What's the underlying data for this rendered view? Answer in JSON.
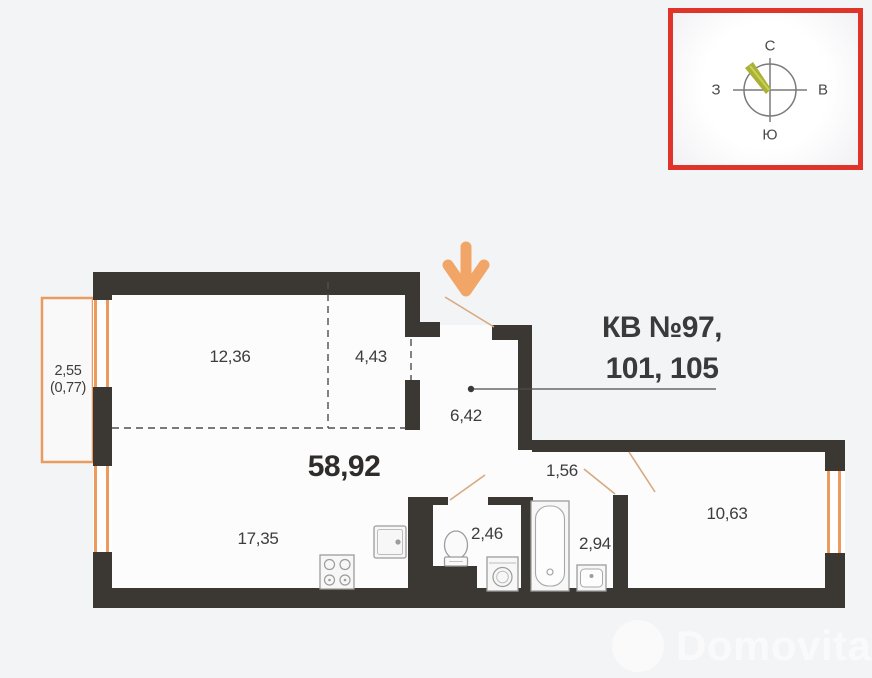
{
  "apartment": {
    "title_line1": "КВ №97,",
    "title_line2": "101, 105",
    "total_area": "58,92"
  },
  "rooms": {
    "bedroom_zone": "12,36",
    "alcove_zone": "4,43",
    "balcony_area": "2,55",
    "balcony_coef": "(0,77)",
    "hallway": "6,42",
    "kitchen_living": "17,35",
    "wc": "2,46",
    "corridor": "1,56",
    "bathroom": "2,94",
    "bedroom": "10,63"
  },
  "compass": {
    "north": "С",
    "south": "Ю",
    "west": "З",
    "east": "В"
  },
  "watermark": {
    "text": "Domovita"
  },
  "colors": {
    "wall": "#3b3733",
    "accent_orange": "#ef9e62",
    "compass_frame_red": "#e0332a",
    "needle_olive": "#a9b138",
    "background": "#f3f4f6"
  }
}
